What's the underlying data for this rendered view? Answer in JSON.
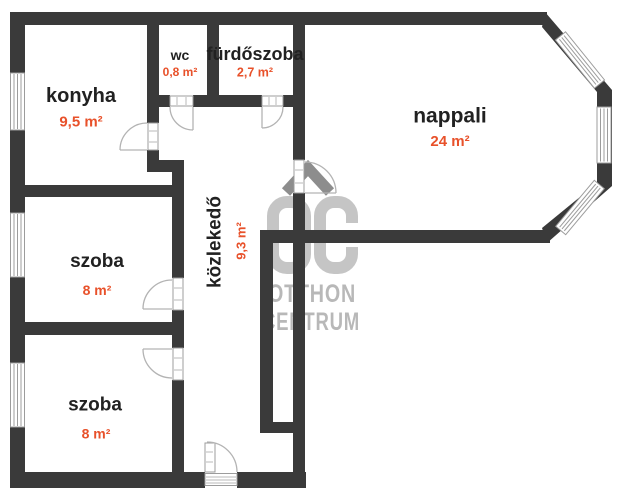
{
  "rooms": [
    {
      "name": "konyha",
      "area": "9,5 m²"
    },
    {
      "name": "wc",
      "area": "0,8 m²"
    },
    {
      "name": "fürdőszoba",
      "area": "2,7 m²"
    },
    {
      "name": "nappali",
      "area": "24 m²"
    },
    {
      "name": "közlekedő",
      "area": "9,3 m²"
    },
    {
      "name": "szoba",
      "area": "8 m²"
    },
    {
      "name": "szoba",
      "area": "8 m²"
    }
  ],
  "watermark": {
    "line1": "OTTHON",
    "line2": "CENTRUM"
  },
  "colors": {
    "wall": "#3a3a3a",
    "room_name_text": "#212121",
    "area_text": "#e8512a",
    "watermark_text": "#b8b8b8",
    "watermark_monogram": "#c5c5c5",
    "watermark_roof": "#8d8d8d",
    "window_frame": "#9c9c9c",
    "door_arc": "#b3b3b3",
    "background": "#ffffff"
  }
}
